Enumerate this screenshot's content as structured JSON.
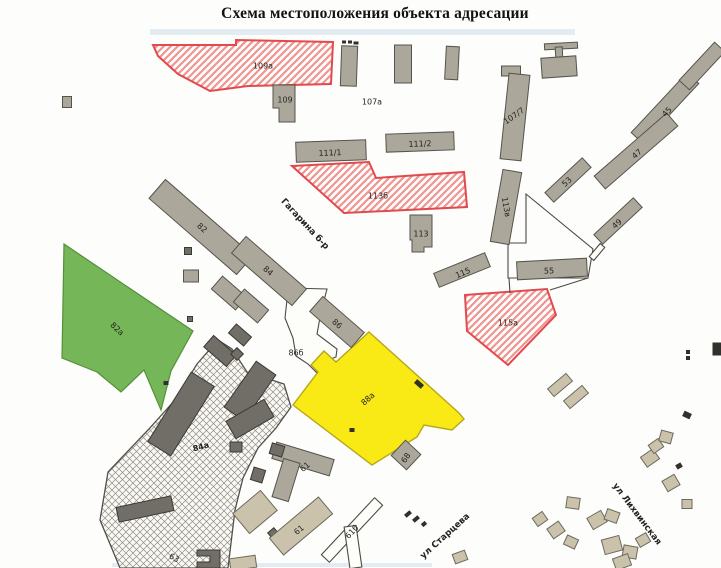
{
  "title": "Схема местоположения объекта адресации",
  "map": {
    "styles": {
      "g": {
        "fill": "#aba79b",
        "stroke": "#56534b",
        "sw": 1
      },
      "d": {
        "fill": "#716e67",
        "stroke": "#3b3933",
        "sw": 1
      },
      "t": {
        "fill": "#cbc2ac",
        "stroke": "#6d695e",
        "sw": 1
      },
      "w": {
        "fill": "#fdfdfa",
        "stroke": "#4c4a42",
        "sw": 1.1
      },
      "wl": {
        "fill": "none",
        "stroke": "#4c4a42",
        "sw": 1.1
      },
      "k": {
        "fill": "#32302b",
        "stroke": "none",
        "sw": 0
      },
      "red": {
        "fill": "url(#redhatch)",
        "stroke": "#e24a4e",
        "sw": 2
      },
      "green": {
        "fill": "#75b758",
        "stroke": "#549038",
        "sw": 1.2
      },
      "yellow": {
        "fill": "#f9e915",
        "stroke": "#b7a71c",
        "sw": 1.4
      },
      "hatch": {
        "fill": "url(#gridhatch)",
        "stroke": "#52504a",
        "sw": 1.3
      },
      "blue": {
        "fill": "#c9dcea",
        "stroke": "none",
        "sw": 0,
        "op": 0.5
      }
    },
    "areas": [
      {
        "name": "scan-stain-top",
        "kind": "blue",
        "points": "150,29 575,29 575,35 150,35"
      },
      {
        "name": "scan-stain-bottom",
        "kind": "blue",
        "points": "112,563 432,563 432,567 112,567"
      },
      {
        "name": "parcel-86b",
        "kind": "w",
        "points": "290,288 327,289 321,312 317,334 337,349 336,357 319,363 317,373 308,364 296,356 293,338 285,318 287,300"
      },
      {
        "name": "parcel-55",
        "kind": "wl",
        "points": "526,194 593,249 588,278 508,278 508,243 526,243"
      },
      {
        "name": "green-area-82a",
        "kind": "green",
        "points": "64,244 193,331 171,371 161,410 144,370 121,392 97,372 62,358"
      },
      {
        "name": "hatched-area-84a",
        "kind": "hatch",
        "points": "218,340 232,349 247,372 284,384 291,407 276,428 258,448 243,478 235,510 228,568 120,568 100,520 108,472 148,430 175,400 197,364"
      },
      {
        "name": "red-parcel-109a",
        "kind": "red",
        "points": "153,45 236,45 236,40 333,42 331,84 248,86 210,91 178,74 158,56"
      },
      {
        "name": "red-parcel-113b",
        "kind": "red",
        "points": "292,166 369,162 376,178 464,172 467,207 344,213"
      },
      {
        "name": "red-parcel-115a",
        "kind": "red",
        "points": "465,295 547,289 556,315 508,365 467,331"
      },
      {
        "name": "yellow-building-88a",
        "kind": "yellow",
        "points": "369,332 459,413 464,419 452,430 424,425 417,437 372,465 293,405 318,372 311,365 324,351 336,362"
      }
    ],
    "buildings": [
      {
        "name": "bld-109",
        "kind": "g",
        "points": "273,85 295,85 295,122 279,122 279,108 273,108"
      },
      {
        "name": "bld-small-1",
        "kind": "g",
        "cx": 349,
        "cy": 66,
        "w": 16,
        "h": 40,
        "r": 2
      },
      {
        "name": "bld-small-2",
        "kind": "g",
        "cx": 403,
        "cy": 64,
        "w": 17,
        "h": 38,
        "r": 0
      },
      {
        "name": "bld-small-3",
        "kind": "g",
        "cx": 452,
        "cy": 63,
        "w": 13,
        "h": 33,
        "r": 3
      },
      {
        "name": "bld-small-4",
        "kind": "g",
        "cx": 511,
        "cy": 71,
        "w": 19,
        "h": 10,
        "r": 0
      },
      {
        "name": "bld-t-top-bar",
        "kind": "g",
        "cx": 561,
        "cy": 46,
        "w": 33,
        "h": 6,
        "r": -3
      },
      {
        "name": "bld-t-stem",
        "kind": "g",
        "cx": 559,
        "cy": 53,
        "w": 7,
        "h": 12,
        "r": -3
      },
      {
        "name": "bld-t-box",
        "kind": "g",
        "cx": 559,
        "cy": 67,
        "w": 35,
        "h": 20,
        "r": -4
      },
      {
        "name": "bld-107-7",
        "kind": "g",
        "cx": 515,
        "cy": 117,
        "w": 21,
        "h": 86,
        "r": 6
      },
      {
        "name": "bld-111-1",
        "kind": "g",
        "cx": 331,
        "cy": 151,
        "w": 70,
        "h": 20,
        "r": -2
      },
      {
        "name": "bld-111-2",
        "kind": "g",
        "cx": 420,
        "cy": 142,
        "w": 68,
        "h": 18,
        "r": -2
      },
      {
        "name": "bld-45",
        "kind": "g",
        "cx": 665,
        "cy": 108,
        "w": 82,
        "h": 16,
        "r": -47
      },
      {
        "name": "bld-45-upper",
        "kind": "g",
        "cx": 702,
        "cy": 66,
        "w": 52,
        "h": 14,
        "r": -47
      },
      {
        "name": "bld-47",
        "kind": "g",
        "cx": 636,
        "cy": 151,
        "w": 96,
        "h": 17,
        "r": -41
      },
      {
        "name": "bld-53",
        "kind": "g",
        "cx": 568,
        "cy": 180,
        "w": 51,
        "h": 13,
        "r": -43
      },
      {
        "name": "bld-49",
        "kind": "g",
        "cx": 618,
        "cy": 221,
        "w": 54,
        "h": 13,
        "r": -43
      },
      {
        "name": "bld-113v",
        "kind": "g",
        "cx": 506,
        "cy": 207,
        "w": 19,
        "h": 73,
        "r": 10
      },
      {
        "name": "bld-55",
        "kind": "g",
        "cx": 552,
        "cy": 269,
        "w": 70,
        "h": 18,
        "r": -3
      },
      {
        "name": "bld-115",
        "kind": "g",
        "cx": 462,
        "cy": 270,
        "w": 55,
        "h": 15,
        "r": -22
      },
      {
        "name": "bld-113",
        "kind": "g",
        "points": "410,215 432,215 432,247 424,247 424,252 412,252 412,240 410,240"
      },
      {
        "name": "bld-82",
        "kind": "g",
        "cx": 201,
        "cy": 227,
        "w": 116,
        "h": 25,
        "r": 41
      },
      {
        "name": "bld-84",
        "kind": "g",
        "cx": 269,
        "cy": 271,
        "w": 80,
        "h": 22,
        "r": 41
      },
      {
        "name": "bld-row-a",
        "kind": "g",
        "cx": 229,
        "cy": 293,
        "w": 32,
        "h": 17,
        "r": 41
      },
      {
        "name": "bld-row-b",
        "kind": "g",
        "cx": 251,
        "cy": 306,
        "w": 32,
        "h": 17,
        "r": 41
      },
      {
        "name": "bld-86",
        "kind": "g",
        "cx": 337,
        "cy": 322,
        "w": 55,
        "h": 20,
        "r": 41
      },
      {
        "name": "bld-edge-left",
        "kind": "g",
        "cx": 67,
        "cy": 102,
        "w": 9,
        "h": 11,
        "r": 0
      },
      {
        "name": "shed-1",
        "kind": "d",
        "cx": 188,
        "cy": 251,
        "w": 7,
        "h": 7,
        "r": 0
      },
      {
        "name": "shed-2",
        "kind": "g",
        "cx": 191,
        "cy": 276,
        "w": 15,
        "h": 12,
        "r": 0
      },
      {
        "name": "shed-3",
        "kind": "d",
        "cx": 190,
        "cy": 319,
        "w": 5,
        "h": 5,
        "r": 0
      },
      {
        "name": "dark-bar-1",
        "kind": "d",
        "cx": 240,
        "cy": 335,
        "w": 20,
        "h": 12,
        "r": 41
      },
      {
        "name": "dark-bar-2",
        "kind": "d",
        "cx": 220,
        "cy": 351,
        "w": 30,
        "h": 15,
        "r": 41
      },
      {
        "name": "dark-diamond",
        "kind": "d",
        "cx": 237,
        "cy": 354,
        "w": 9,
        "h": 9,
        "r": 45
      },
      {
        "name": "dark-big-bar",
        "kind": "d",
        "cx": 181,
        "cy": 414,
        "w": 82,
        "h": 27,
        "r": -58
      },
      {
        "name": "dark-mid-bar",
        "kind": "d",
        "cx": 250,
        "cy": 391,
        "w": 56,
        "h": 24,
        "r": -55
      },
      {
        "name": "dark-mid-bar-2",
        "kind": "d",
        "cx": 250,
        "cy": 419,
        "w": 44,
        "h": 20,
        "r": -30
      },
      {
        "name": "dark-sq",
        "kind": "d",
        "cx": 236,
        "cy": 447,
        "w": 12,
        "h": 10,
        "r": 0
      },
      {
        "name": "dark-bottom-bar",
        "kind": "d",
        "cx": 145,
        "cy": 509,
        "w": 56,
        "h": 15,
        "r": -12
      },
      {
        "name": "dark-l-bld",
        "kind": "d",
        "points": "197,550 220,550 220,568 197,568 197,562 210,562 210,556 197,556"
      },
      {
        "name": "tan-bottom-edge",
        "kind": "t",
        "cx": 243,
        "cy": 563,
        "w": 26,
        "h": 12,
        "r": -8
      },
      {
        "name": "bld-61-t-bar",
        "kind": "g",
        "cx": 303,
        "cy": 459,
        "w": 60,
        "h": 17,
        "r": 17
      },
      {
        "name": "bld-61-t-stem",
        "kind": "g",
        "cx": 286,
        "cy": 480,
        "w": 17,
        "h": 40,
        "r": 17
      },
      {
        "name": "bld-61-t-corner",
        "kind": "d",
        "cx": 277,
        "cy": 450,
        "w": 13,
        "h": 11,
        "r": 17
      },
      {
        "name": "shed-4",
        "kind": "d",
        "cx": 258,
        "cy": 475,
        "w": 12,
        "h": 13,
        "r": 17
      },
      {
        "name": "tan-bld-1",
        "kind": "t",
        "cx": 255,
        "cy": 512,
        "w": 36,
        "h": 26,
        "r": -40
      },
      {
        "name": "shed-5",
        "kind": "d",
        "cx": 273,
        "cy": 533,
        "w": 8,
        "h": 7,
        "r": -40
      },
      {
        "name": "bld-61-tan",
        "kind": "t",
        "cx": 301,
        "cy": 526,
        "w": 64,
        "h": 22,
        "r": -40
      },
      {
        "name": "bld-61b",
        "kind": "w",
        "cx": 352,
        "cy": 530,
        "w": 78,
        "h": 11,
        "r": -47
      },
      {
        "name": "white-bar-vert",
        "kind": "w",
        "cx": 353,
        "cy": 547,
        "w": 12,
        "h": 42,
        "r": -8
      },
      {
        "name": "bld-68",
        "kind": "g",
        "cx": 406,
        "cy": 455,
        "w": 21,
        "h": 21,
        "r": 43
      },
      {
        "name": "white-thin-bar",
        "kind": "w",
        "cx": 597,
        "cy": 252,
        "w": 17,
        "h": 6,
        "r": -50
      },
      {
        "name": "tan-1",
        "kind": "t",
        "cx": 560,
        "cy": 385,
        "w": 24,
        "h": 10,
        "r": -40
      },
      {
        "name": "tan-2",
        "kind": "t",
        "cx": 576,
        "cy": 397,
        "w": 24,
        "h": 10,
        "r": -40
      },
      {
        "name": "tan-3",
        "kind": "t",
        "cx": 573,
        "cy": 503,
        "w": 13,
        "h": 11,
        "r": 8
      },
      {
        "name": "tan-4",
        "kind": "t",
        "cx": 597,
        "cy": 520,
        "w": 16,
        "h": 13,
        "r": -30
      },
      {
        "name": "tan-5",
        "kind": "t",
        "cx": 612,
        "cy": 516,
        "w": 13,
        "h": 11,
        "r": 20
      },
      {
        "name": "tan-6",
        "kind": "t",
        "cx": 612,
        "cy": 545,
        "w": 18,
        "h": 15,
        "r": -15
      },
      {
        "name": "tan-7",
        "kind": "t",
        "cx": 630,
        "cy": 552,
        "w": 14,
        "h": 12,
        "r": 10
      },
      {
        "name": "tan-8",
        "kind": "t",
        "cx": 643,
        "cy": 540,
        "w": 12,
        "h": 10,
        "r": -30
      },
      {
        "name": "tan-9",
        "kind": "t",
        "cx": 650,
        "cy": 458,
        "w": 15,
        "h": 12,
        "r": -35
      },
      {
        "name": "tan-10",
        "kind": "t",
        "cx": 656,
        "cy": 446,
        "w": 12,
        "h": 10,
        "r": -35
      },
      {
        "name": "tan-11",
        "kind": "t",
        "cx": 666,
        "cy": 437,
        "w": 12,
        "h": 11,
        "r": 15
      },
      {
        "name": "tan-12",
        "kind": "t",
        "cx": 671,
        "cy": 483,
        "w": 14,
        "h": 12,
        "r": -30
      },
      {
        "name": "tan-13",
        "kind": "t",
        "cx": 687,
        "cy": 504,
        "w": 10,
        "h": 9,
        "r": 0
      },
      {
        "name": "tan-14",
        "kind": "t",
        "cx": 622,
        "cy": 562,
        "w": 16,
        "h": 12,
        "r": -20
      },
      {
        "name": "tan-15",
        "kind": "t",
        "cx": 571,
        "cy": 542,
        "w": 12,
        "h": 10,
        "r": 25
      },
      {
        "name": "tan-16",
        "kind": "t",
        "cx": 540,
        "cy": 519,
        "w": 12,
        "h": 10,
        "r": -35
      },
      {
        "name": "tan-17",
        "kind": "t",
        "cx": 556,
        "cy": 530,
        "w": 14,
        "h": 12,
        "r": -35
      },
      {
        "name": "tan-18",
        "kind": "t",
        "cx": 460,
        "cy": 557,
        "w": 13,
        "h": 10,
        "r": -20
      }
    ],
    "lines": [
      {
        "x1": 509,
        "y1": 278,
        "x2": 510,
        "y2": 293
      },
      {
        "x1": 588,
        "y1": 278,
        "x2": 550,
        "y2": 290
      }
    ],
    "marks": [
      {
        "cx": 344,
        "cy": 42,
        "w": 4,
        "h": 3,
        "r": 0
      },
      {
        "cx": 350,
        "cy": 42,
        "w": 4,
        "h": 3,
        "r": 0
      },
      {
        "cx": 356,
        "cy": 43,
        "w": 5,
        "h": 3,
        "r": 0
      },
      {
        "cx": 408,
        "cy": 514,
        "w": 7,
        "h": 4,
        "r": -40
      },
      {
        "cx": 416,
        "cy": 519,
        "w": 7,
        "h": 4,
        "r": -40
      },
      {
        "cx": 424,
        "cy": 524,
        "w": 5,
        "h": 4,
        "r": -40
      },
      {
        "cx": 688,
        "cy": 352,
        "w": 4,
        "h": 4,
        "r": 0
      },
      {
        "cx": 688,
        "cy": 358,
        "w": 4,
        "h": 4,
        "r": 0
      },
      {
        "cx": 687,
        "cy": 415,
        "w": 8,
        "h": 6,
        "r": 25
      },
      {
        "cx": 679,
        "cy": 466,
        "w": 6,
        "h": 5,
        "r": -30
      },
      {
        "cx": 166,
        "cy": 383,
        "w": 5,
        "h": 4,
        "r": 0
      },
      {
        "cx": 717,
        "cy": 349,
        "w": 9,
        "h": 13,
        "r": 0
      },
      {
        "cx": 352,
        "cy": 430,
        "w": 5,
        "h": 4,
        "r": 0
      },
      {
        "cx": 419,
        "cy": 384,
        "w": 9,
        "h": 5,
        "r": 41
      }
    ],
    "labels": [
      {
        "name": "label-109a",
        "t": "109а",
        "x": 263,
        "y": 66,
        "r": 0
      },
      {
        "name": "label-109",
        "t": "109",
        "x": 285,
        "y": 100,
        "r": 0
      },
      {
        "name": "label-107a",
        "t": "107а",
        "x": 372,
        "y": 102,
        "r": 0
      },
      {
        "name": "label-111-1",
        "t": "111/1",
        "x": 330,
        "y": 153,
        "r": -2
      },
      {
        "name": "label-111-2",
        "t": "111/2",
        "x": 420,
        "y": 144,
        "r": -2
      },
      {
        "name": "label-107-7",
        "t": "107/7",
        "x": 514,
        "y": 116,
        "r": -35
      },
      {
        "name": "label-45",
        "t": "45",
        "x": 667,
        "y": 112,
        "r": -47
      },
      {
        "name": "label-47",
        "t": "47",
        "x": 637,
        "y": 154,
        "r": -41
      },
      {
        "name": "label-53",
        "t": "53",
        "x": 567,
        "y": 182,
        "r": -43
      },
      {
        "name": "label-49",
        "t": "49",
        "x": 617,
        "y": 224,
        "r": -43
      },
      {
        "name": "label-113b",
        "t": "113б",
        "x": 378,
        "y": 196,
        "r": 0
      },
      {
        "name": "label-113",
        "t": "113",
        "x": 421,
        "y": 234,
        "r": 0
      },
      {
        "name": "label-113v",
        "t": "113в",
        "x": 506,
        "y": 207,
        "r": 80
      },
      {
        "name": "label-55",
        "t": "55",
        "x": 549,
        "y": 271,
        "r": -2
      },
      {
        "name": "label-115",
        "t": "115",
        "x": 463,
        "y": 273,
        "r": -24
      },
      {
        "name": "label-115a",
        "t": "115а",
        "x": 508,
        "y": 323,
        "r": 0
      },
      {
        "name": "label-82",
        "t": "82",
        "x": 202,
        "y": 228,
        "r": 41
      },
      {
        "name": "label-84",
        "t": "84",
        "x": 268,
        "y": 271,
        "r": 41
      },
      {
        "name": "label-86",
        "t": "86",
        "x": 337,
        "y": 324,
        "r": 41
      },
      {
        "name": "label-82a",
        "t": "82а",
        "x": 117,
        "y": 329,
        "r": 42
      },
      {
        "name": "label-88a",
        "t": "88а",
        "x": 368,
        "y": 399,
        "r": -42,
        "c": "#55523c"
      },
      {
        "name": "label-84a",
        "t": "84а",
        "x": 201,
        "y": 447,
        "r": -15,
        "bold": true
      },
      {
        "name": "label-86b",
        "t": "86б",
        "x": 296,
        "y": 353,
        "r": 0
      },
      {
        "name": "label-61-t",
        "t": "61",
        "x": 305,
        "y": 467,
        "r": -40
      },
      {
        "name": "label-61-tan",
        "t": "61",
        "x": 299,
        "y": 530,
        "r": -40
      },
      {
        "name": "label-61b",
        "t": "61б",
        "x": 352,
        "y": 532,
        "r": -47
      },
      {
        "name": "label-63",
        "t": "63",
        "x": 174,
        "y": 558,
        "r": 30
      },
      {
        "name": "label-68",
        "t": "68",
        "x": 406,
        "y": 458,
        "r": -55
      }
    ],
    "streets": [
      {
        "name": "street-gagarina",
        "t": "Гагарина б-р",
        "x": 305,
        "y": 224,
        "r": 47
      },
      {
        "name": "street-startseva",
        "t": "ул Старцева",
        "x": 445,
        "y": 536,
        "r": -42
      },
      {
        "name": "street-likhvinskaya",
        "t": "ул Лихвинская",
        "x": 637,
        "y": 514,
        "r": 53
      }
    ]
  }
}
